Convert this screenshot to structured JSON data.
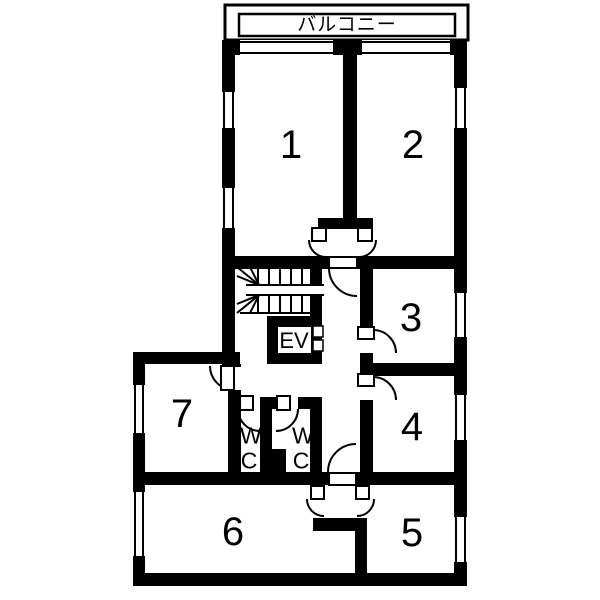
{
  "floor_plan": {
    "balcony_label": "バルコニー",
    "elevator_label": "EV",
    "wc_left_label": "WC",
    "wc_right_label": "WC",
    "rooms": [
      {
        "id": "room-1",
        "number": "1"
      },
      {
        "id": "room-2",
        "number": "2"
      },
      {
        "id": "room-3",
        "number": "3"
      },
      {
        "id": "room-4",
        "number": "4"
      },
      {
        "id": "room-5",
        "number": "5"
      },
      {
        "id": "room-6",
        "number": "6"
      },
      {
        "id": "room-7",
        "number": "7"
      }
    ],
    "colors": {
      "wall": "#000000",
      "floor": "#ffffff"
    }
  }
}
